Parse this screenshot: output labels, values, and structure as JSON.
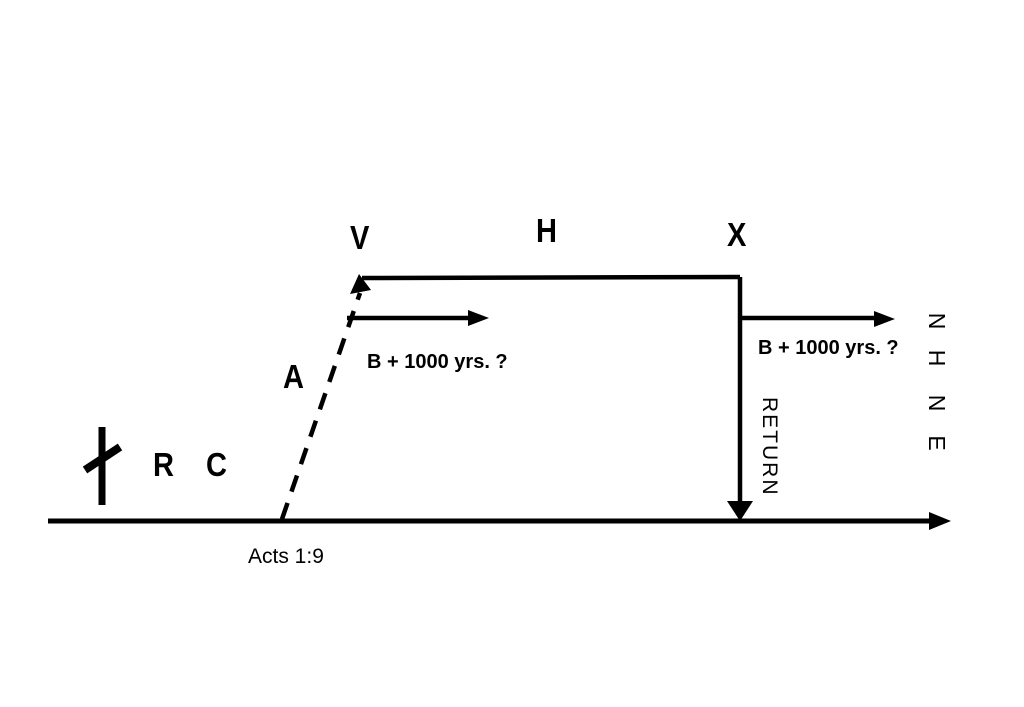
{
  "colors": {
    "ink": "#000000",
    "background": "#ffffff"
  },
  "icons": {
    "cross": "latin-cross"
  },
  "nodes": {
    "r": "R",
    "c": "C",
    "a": "A",
    "v": "V",
    "h": "H",
    "x": "X"
  },
  "annotations": {
    "acts_ref": "Acts 1:9",
    "millennium_left": "B + 1000 yrs. ?",
    "millennium_right": "B + 1000 yrs. ?",
    "return_label": "RETURN",
    "nhne_letters": [
      "N",
      "H",
      "N",
      "E"
    ]
  }
}
